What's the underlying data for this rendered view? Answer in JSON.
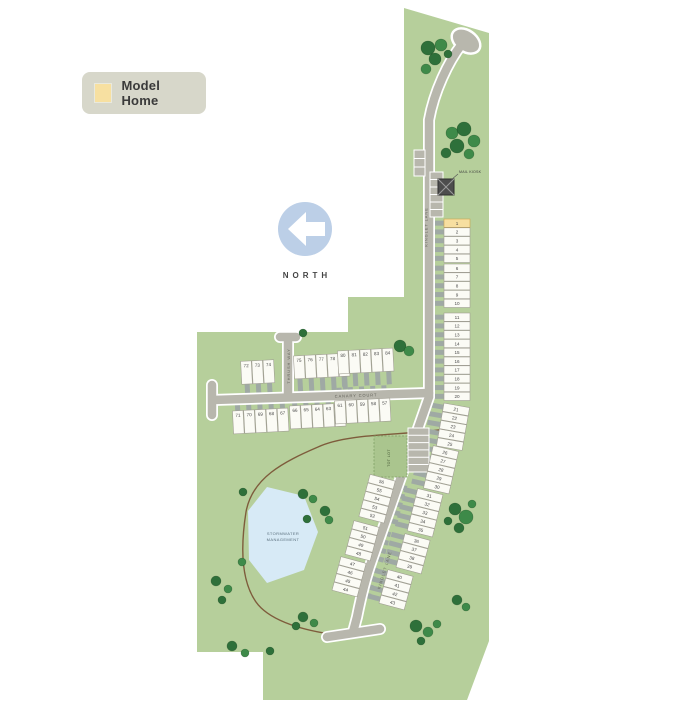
{
  "legend": {
    "label": "Model Home",
    "swatch_color": "#f7e0a1"
  },
  "north_label": "NORTH",
  "map": {
    "colors": {
      "site_green": "#b6cf9b",
      "road": "#b8b7ad",
      "road_casing": "#ffffff",
      "driveway": "#9fa9a4",
      "lot_fill": "#fbfbf5",
      "lot_stroke": "#a19f94",
      "lot_number": "#4a4a4a",
      "model_fill": "#f7dfa0",
      "model_stroke": "#caa44c",
      "tree_dark": "#2e703a",
      "tree_light": "#3e8a49",
      "pond": "#d7eaf6",
      "pond_label": "#5a6f7d",
      "trail": "#7e5c3c",
      "amenity_fill": "#aac58e",
      "amenity_stroke": "#7fa065",
      "kiosk": "#4d4d4d",
      "north_blue": "#bccfe7"
    },
    "labels": {
      "street_main": "KINGLET LANE",
      "street_main_lower": "KINGLET LANE",
      "street_canary": "CANARY COURT",
      "street_spur": "THRUSH WAY",
      "mail_kiosk": "MAIL KIOSK",
      "amenity": "TOT LOT",
      "pond": [
        "STORMWATER",
        "MANAGEMENT"
      ]
    },
    "model_home_lot": 1,
    "lot_groups": [
      {
        "type": "stack",
        "cx": 457,
        "cy": 241,
        "rot": 0,
        "side": "west",
        "lots": [
          1,
          2,
          3,
          4,
          5
        ]
      },
      {
        "type": "stack",
        "cx": 457,
        "cy": 286,
        "rot": 0,
        "side": "west",
        "lots": [
          6,
          7,
          8,
          9,
          10
        ]
      },
      {
        "type": "stack",
        "cx": 457,
        "cy": 335,
        "rot": 0,
        "side": "west",
        "lots": [
          11,
          12,
          13,
          14,
          15
        ]
      },
      {
        "type": "stack",
        "cx": 457,
        "cy": 379,
        "rot": 0,
        "side": "west",
        "lots": [
          16,
          17,
          18,
          19,
          20
        ]
      },
      {
        "type": "stack",
        "cx": 453,
        "cy": 427,
        "rot": 10,
        "side": "west",
        "lots": [
          21,
          22,
          23,
          24,
          25
        ]
      },
      {
        "type": "stack",
        "cx": 441,
        "cy": 470,
        "rot": 13,
        "side": "west",
        "lots": [
          26,
          27,
          28,
          29,
          30
        ]
      },
      {
        "type": "stack",
        "cx": 425,
        "cy": 513,
        "rot": 14,
        "side": "west",
        "lots": [
          31,
          32,
          33,
          34,
          35
        ]
      },
      {
        "type": "stack",
        "cx": 413,
        "cy": 554,
        "rot": 15,
        "side": "west",
        "lots": [
          36,
          37,
          38,
          39
        ]
      },
      {
        "type": "stack",
        "cx": 396,
        "cy": 590,
        "rot": 15,
        "side": "west",
        "lots": [
          40,
          41,
          42,
          43
        ]
      },
      {
        "type": "stack",
        "cx": 377,
        "cy": 499,
        "rot": 15,
        "side": "east",
        "lots": [
          56,
          55,
          54,
          53,
          52
        ]
      },
      {
        "type": "stack",
        "cx": 362,
        "cy": 541,
        "rot": 15,
        "side": "east",
        "lots": [
          51,
          50,
          49,
          48
        ]
      },
      {
        "type": "stack",
        "cx": 349,
        "cy": 577,
        "rot": 15,
        "side": "east",
        "lots": [
          47,
          46,
          45,
          44
        ]
      },
      {
        "type": "row",
        "cx": 258,
        "cy": 372,
        "rot": -3,
        "side": "south",
        "lots": [
          72,
          73,
          74
        ]
      },
      {
        "type": "row",
        "cx": 322,
        "cy": 366,
        "rot": -3,
        "side": "south",
        "lots": [
          75,
          76,
          77,
          78,
          79
        ]
      },
      {
        "type": "row",
        "cx": 366,
        "cy": 361,
        "rot": -3,
        "side": "south",
        "lots": [
          80,
          81,
          82,
          83,
          84
        ]
      },
      {
        "type": "row",
        "cx": 261,
        "cy": 421,
        "rot": -3,
        "side": "north",
        "lots": [
          71,
          70,
          69,
          68,
          67
        ]
      },
      {
        "type": "row",
        "cx": 318,
        "cy": 416,
        "rot": -3,
        "side": "north",
        "lots": [
          66,
          65,
          64,
          63,
          62
        ]
      },
      {
        "type": "row",
        "cx": 363,
        "cy": 411,
        "rot": -3,
        "side": "north",
        "lots": [
          61,
          60,
          59,
          58,
          57
        ]
      }
    ],
    "trees": [
      [
        428,
        48,
        7,
        0
      ],
      [
        441,
        45,
        6,
        1
      ],
      [
        435,
        59,
        6,
        0
      ],
      [
        426,
        69,
        5,
        1
      ],
      [
        448,
        54,
        4,
        0
      ],
      [
        452,
        133,
        6,
        1
      ],
      [
        464,
        129,
        7,
        0
      ],
      [
        474,
        141,
        6,
        1
      ],
      [
        457,
        146,
        7,
        0
      ],
      [
        446,
        153,
        5,
        0
      ],
      [
        469,
        154,
        5,
        1
      ],
      [
        400,
        346,
        6,
        0
      ],
      [
        409,
        351,
        5,
        1
      ],
      [
        303,
        333,
        4,
        0
      ],
      [
        455,
        509,
        6,
        0
      ],
      [
        466,
        517,
        7,
        1
      ],
      [
        459,
        528,
        5,
        0
      ],
      [
        472,
        504,
        4,
        1
      ],
      [
        448,
        521,
        4,
        0
      ],
      [
        303,
        494,
        5,
        0
      ],
      [
        313,
        499,
        4,
        1
      ],
      [
        325,
        511,
        5,
        0
      ],
      [
        329,
        520,
        4,
        1
      ],
      [
        307,
        519,
        4,
        0
      ],
      [
        243,
        492,
        4,
        0
      ],
      [
        242,
        562,
        4,
        1
      ],
      [
        216,
        581,
        5,
        0
      ],
      [
        228,
        589,
        4,
        1
      ],
      [
        222,
        600,
        4,
        0
      ],
      [
        232,
        646,
        5,
        0
      ],
      [
        245,
        653,
        4,
        1
      ],
      [
        270,
        651,
        4,
        0
      ],
      [
        303,
        617,
        5,
        0
      ],
      [
        314,
        623,
        4,
        1
      ],
      [
        296,
        626,
        4,
        0
      ],
      [
        416,
        626,
        6,
        0
      ],
      [
        428,
        632,
        5,
        1
      ],
      [
        421,
        641,
        4,
        0
      ],
      [
        437,
        624,
        4,
        1
      ],
      [
        457,
        600,
        5,
        0
      ],
      [
        466,
        607,
        4,
        1
      ]
    ]
  }
}
